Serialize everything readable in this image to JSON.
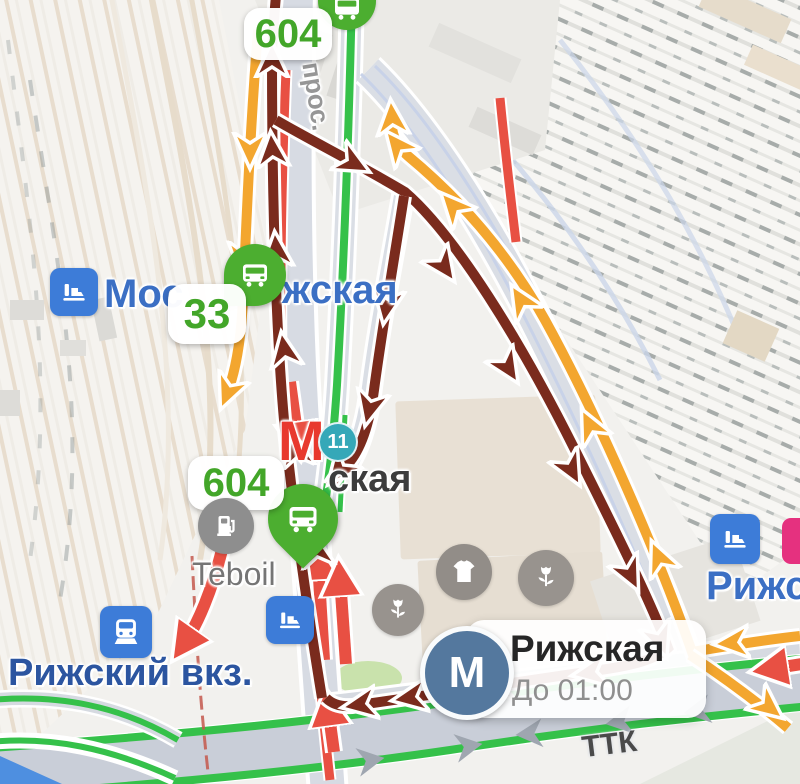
{
  "badges": {
    "route_top": "604",
    "route_mid": "604",
    "route_side": "33",
    "road_shield": "11"
  },
  "labels": {
    "street_vertical": "прос.",
    "station_left_prefix": "Мос",
    "station_left_suffix": "жская",
    "metro_label_partial": "ская",
    "fuel_brand": "Teboil",
    "rail_terminal": "Рижский вкз.",
    "station_right_partial": "Рижс",
    "ring_road": "ТТК"
  },
  "metro_popup": {
    "letter": "М",
    "station": "Рижская",
    "schedule": "До 01:00"
  },
  "metro_mark": {
    "letter": "М"
  },
  "icons": {
    "bus-stop-pin": "white bus glyph in green pin",
    "bus-stop-circle": "white bus glyph in green circle",
    "suburban-train-icon": "white locomotive on blue square",
    "train-terminal-icon": "white train front on blue square",
    "platform-icon": "white tram/platform on blue square",
    "fuel-station-icon": "white fuel pump in gray circle",
    "clothing-store-icon": "white t-shirt in gray circle",
    "flower-shop-icon": "white tulip in gray circle",
    "metro-logo": "white М in slate-blue circle",
    "metro-red-mark": "red М map symbol",
    "mcd-line-icon": "pink square, cut off at edge"
  },
  "colors": {
    "route_dark": "#7A2B1D",
    "route_yellow": "#F3A62F",
    "traffic_green": "#35C14A",
    "traffic_red": "#E85043",
    "transit_green": "#4CAE30",
    "badge_text_green": "#43A629",
    "metro_popup_blue": "#54789E",
    "metro_red": "#E8392E",
    "rail_icon_blue": "#3D7CD8",
    "label_blue": "#3B6FC4",
    "road_shield_teal": "#35A8B8",
    "mcd_pink": "#E5317F"
  }
}
